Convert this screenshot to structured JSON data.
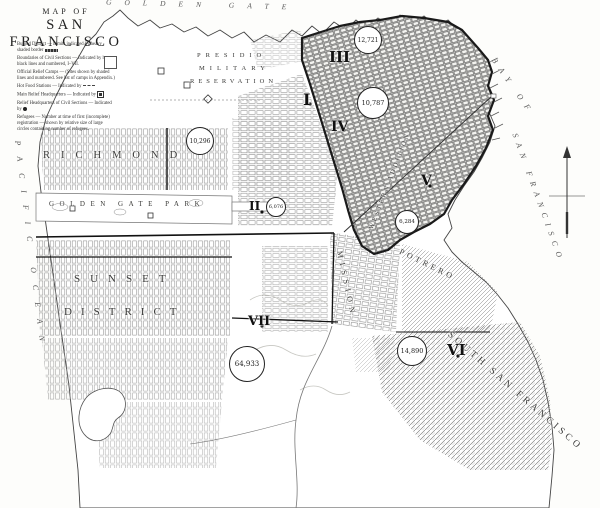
{
  "title": {
    "kicker": "MAP OF",
    "name": "SAN FRANCISCO"
  },
  "legend": {
    "items": [
      "Burned District — Limits indicated by heavy shaded border",
      "Boundaries of Civil Sections — Indicated by heavy black lines and numbered, I–VII.",
      "Official Relief Camps — (Sites shown by shaded lines and numbered. See list of camps in Appendix.)",
      "Hot Food Stations — Indicated by",
      "Main Relief Headquarters — Indicated by",
      "Relief Headquarters of Civil Sections — Indicated by",
      "Refugees — Number at time of first (incomplete) registration — shown by relative size of large circles containing number of refugees."
    ]
  },
  "water": {
    "golden_gate": "GOLDEN GATE",
    "pacific_ocean": "PACIFIC OCEAN",
    "bay_1": "BAY OF",
    "bay_2": "SAN FRANCISCO"
  },
  "places": {
    "presidio_line1": "PRESIDIO",
    "presidio_line2": "MILITARY",
    "presidio_line3": "RESERVATION",
    "richmond": "RICHMOND",
    "golden_gate_park": "GOLDEN GATE PARK",
    "sunset_line1": "SUNSET",
    "sunset_line2": "DISTRICT",
    "western_addition": "WESTERN ADDITION",
    "mission": "MISSION",
    "potrero": "POTRERO",
    "south_san_francisco": "SOUTH SAN FRANCISCO"
  },
  "sections": [
    {
      "numeral": "I",
      "refugees": "10,296"
    },
    {
      "numeral": "II",
      "refugees": "6,076"
    },
    {
      "numeral": "III",
      "refugees": "12,721"
    },
    {
      "numeral": "IV",
      "refugees": "10,787"
    },
    {
      "numeral": "V",
      "refugees": "6,284"
    },
    {
      "numeral": "VI",
      "refugees": "14,890"
    },
    {
      "numeral": "VII",
      "refugees": "64,933"
    }
  ],
  "colors": {
    "ink": "#1a1a1a",
    "paper": "#fdfdfb",
    "hatch": "#8f8f8f",
    "burned_border": "#1a1a1a"
  }
}
